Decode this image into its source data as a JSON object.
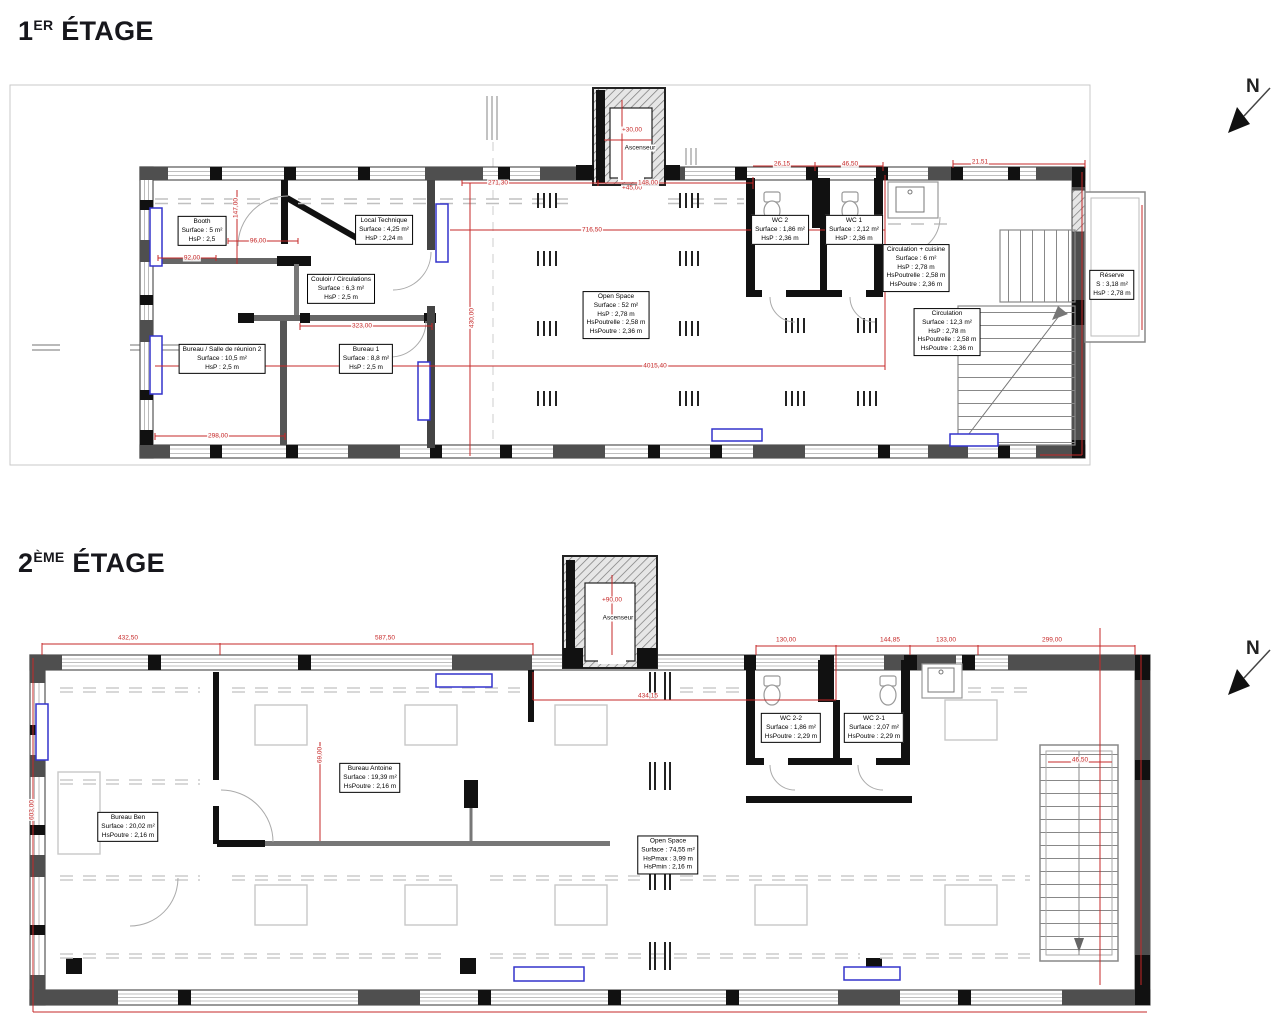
{
  "titles": {
    "floor1": {
      "num": "1",
      "sup": "ER",
      "word": "ÉTAGE"
    },
    "floor2": {
      "num": "2",
      "sup": "ÈME",
      "word": "ÉTAGE"
    }
  },
  "north": {
    "label": "N"
  },
  "colors": {
    "dimension_red": "#c62828",
    "radiator_blue": "#3333cc",
    "wall_grey": "#6a6a6a",
    "wall_black": "#111111"
  },
  "floor1": {
    "elevator": {
      "name": "Ascenseur",
      "level_top": "+30,00",
      "level_door": "+45,00"
    },
    "rooms": [
      {
        "name": "Booth",
        "lines": [
          "Surface : 5 m²",
          "HsP : 2,5"
        ]
      },
      {
        "name": "Local Technique",
        "lines": [
          "Surface : 4,25 m²",
          "HsP : 2,24 m"
        ]
      },
      {
        "name": "Couloir / Circulations",
        "lines": [
          "Surface : 6,3 m²",
          "HsP : 2,5 m"
        ]
      },
      {
        "name": "Bureau / Salle de réunion 2",
        "lines": [
          "Surface : 10,5 m²",
          "HsP : 2,5 m"
        ]
      },
      {
        "name": "Bureau 1",
        "lines": [
          "Surface : 8,8 m²",
          "HsP : 2,5 m"
        ]
      },
      {
        "name": "Open Space",
        "lines": [
          "Surface : 52 m²",
          "HsP : 2,78 m",
          "HsPoutrelle : 2,58 m",
          "HsPoutre : 2,36 m"
        ]
      },
      {
        "name": "WC 2",
        "lines": [
          "Surface : 1,86 m²",
          "HsP : 2,36 m"
        ]
      },
      {
        "name": "WC 1",
        "lines": [
          "Surface : 2,12 m²",
          "HsP : 2,36 m"
        ]
      },
      {
        "name": "Circulation + cuisine",
        "lines": [
          "Surface : 6 m²",
          "HsP : 2,78 m",
          "HsPoutrelle : 2,58 m",
          "HsPoutre : 2,36 m"
        ]
      },
      {
        "name": "Circulation",
        "lines": [
          "Surface : 12,3 m²",
          "HsP : 2,78 m",
          "HsPoutrelle : 2,58 m",
          "HsPoutre : 2,36 m"
        ]
      },
      {
        "name": "Réserve",
        "lines": [
          "S : 3,18 m²",
          "HsP : 2,78 m"
        ]
      }
    ],
    "dims": [
      "271,30",
      "148,00",
      "716,50",
      "4015,40",
      "26,15",
      "46,50",
      "21,51",
      "92,00",
      "96,00",
      "323,00",
      "298,00",
      "147,00",
      "430,00"
    ]
  },
  "floor2": {
    "elevator": {
      "name": "Ascenseur",
      "level": "+90,00"
    },
    "rooms": [
      {
        "name": "Bureau Ben",
        "lines": [
          "Surface : 20,02 m²",
          "HsPoutre : 2,16 m"
        ]
      },
      {
        "name": "Bureau Antoine",
        "lines": [
          "Surface : 19,39 m²",
          "HsPoutre : 2,16 m"
        ]
      },
      {
        "name": "Open Space",
        "lines": [
          "Surface : 74,55 m²",
          "HsPmax : 3,99 m",
          "HsPmin : 2,16 m"
        ]
      },
      {
        "name": "WC 2-2",
        "lines": [
          "Surface : 1,86 m²",
          "HsPoutre : 2,29 m"
        ]
      },
      {
        "name": "WC 2-1",
        "lines": [
          "Surface : 2,07 m²",
          "HsPoutre : 2,29 m"
        ]
      }
    ],
    "dims": [
      "432,50",
      "587,50",
      "130,00",
      "144,85",
      "133,00",
      "299,00",
      "434,15",
      "603,00",
      "46,50",
      "69,00"
    ]
  }
}
